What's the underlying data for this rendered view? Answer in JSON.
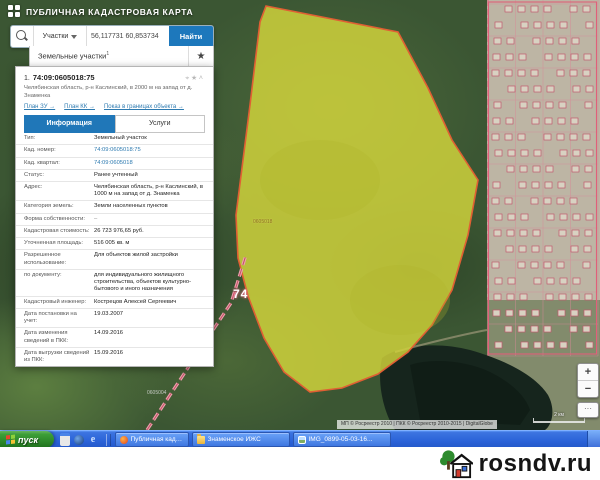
{
  "header": {
    "title": "ПУБЛИЧНАЯ КАДАСТРОВАЯ КАРТА"
  },
  "search": {
    "category": "Участки",
    "query": "56,117731 60,853734",
    "find_label": "Найти",
    "results_title": "Земельные участки",
    "results_count": "1",
    "star_icon": "★"
  },
  "panel": {
    "item_number": "1.",
    "cad_number": "74:09:0605018:75",
    "address_line": "Челябинская область, р-н Каслинский, в 2000 м на запад от д. Знаменка",
    "action_icons": [
      "⌖",
      "★",
      "˄"
    ],
    "links": [
      {
        "label": "План ЗУ →"
      },
      {
        "label": "План КК →"
      },
      {
        "label": "Показ в границах объекта →"
      }
    ],
    "tabs": [
      {
        "label": "Информация"
      },
      {
        "label": "Услуги"
      }
    ],
    "rows": [
      {
        "label": "Тип:",
        "value": "Земельный участок"
      },
      {
        "label": "Кад. номер:",
        "value": "74:09:0605018:75"
      },
      {
        "label": "Кад. квартал:",
        "value": "74:09:0605018"
      },
      {
        "label": "Статус:",
        "value": "Ранее учтенный"
      },
      {
        "label": "Адрес:",
        "value": "Челябинская область, р-н Каслинский, в 1000 м на запад от д. Знаменка"
      },
      {
        "label": "Категория земель:",
        "value": "Земли населенных пунктов"
      },
      {
        "label": "Форма собственности:",
        "value": "–"
      },
      {
        "label": "Кадастровая стоимость:",
        "value": "26 723 976,65 руб."
      },
      {
        "label": "Уточненная площадь:",
        "value": "516 005 кв. м"
      },
      {
        "label": "Разрешенное использование:",
        "value": "Для объектов жилой застройки"
      },
      {
        "label": "по документу:",
        "value": "для индивидуального жилищного строительства, объектов культурно-бытового и иного назначения"
      },
      {
        "label": "Кадастровый инженер:",
        "value": "Кострецов Алексей Сергеевич"
      },
      {
        "label": "Дата постановки на учет:",
        "value": "19.03.2007"
      },
      {
        "label": "Дата изменения сведений в ПКК:",
        "value": "14.09.2016"
      },
      {
        "label": "Дата выгрузки сведений из ПКК:",
        "value": "15.09.2016"
      }
    ]
  },
  "map": {
    "region_code": "74",
    "parcel_label": "0605018",
    "quarter_label": "0605004",
    "attribution": "МП © Росреестр 2010 | ПКК © Росреестр 2010-2015 | DigitalGlobe",
    "scale_label": "2 км",
    "zoom_in": "+",
    "zoom_out": "−",
    "more": "···",
    "parcel_fill": "#d8d93c",
    "parcel_stroke": "#e05f33",
    "boundary_color": "#f0a0b0"
  },
  "taskbar": {
    "start_label": "пуск",
    "ie_icon": "e",
    "tasks": [
      {
        "label": "Публичная кадастр..."
      },
      {
        "label": "Знаменское ИЖС"
      },
      {
        "label": "IMG_0899-05-03-16..."
      }
    ]
  },
  "watermark": {
    "text": "rosndv.ru"
  }
}
